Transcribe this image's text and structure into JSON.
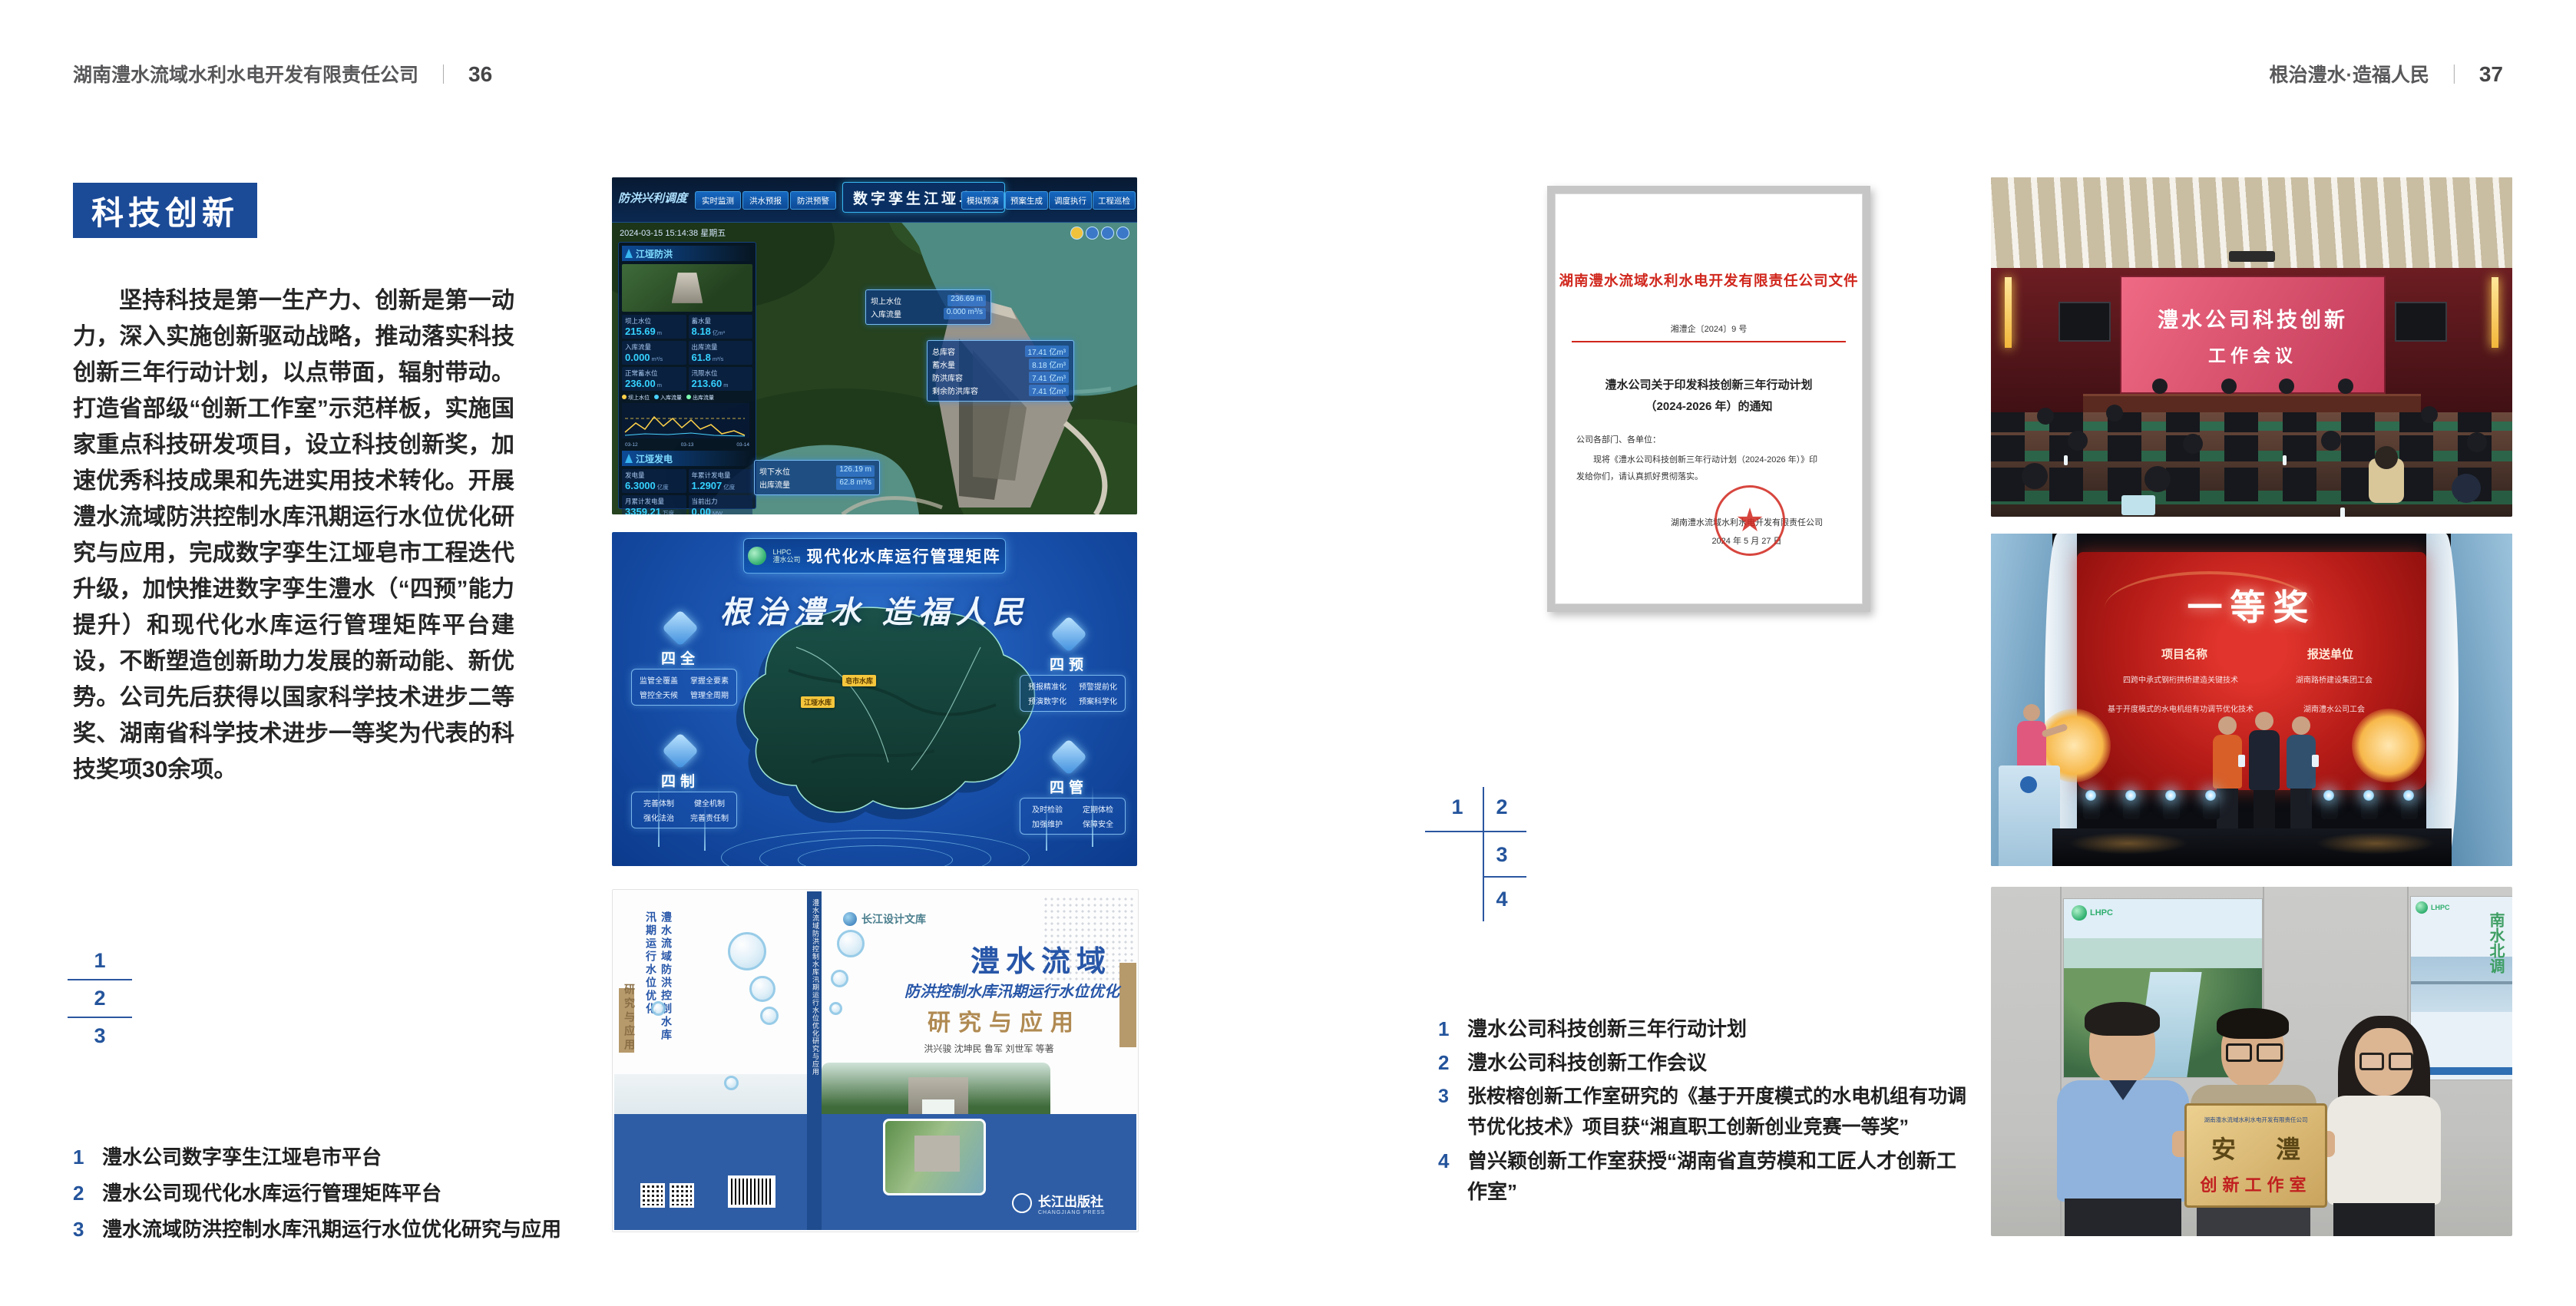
{
  "left": {
    "header": {
      "company": "湖南澧水流域水利水电开发有限责任公司",
      "sep": "｜",
      "page": "36"
    },
    "section_title": "科技创新",
    "body": "坚持科技是第一生产力、创新是第一动力，深入实施创新驱动战略，推动落实科技创新三年行动计划，以点带面，辐射带动。打造省部级“创新工作室”示范样板，实施国家重点科技研发项目，设立科技创新奖，加速优秀科技成果和先进实用技术转化。开展澧水流域防洪控制水库汛期运行水位优化研究与应用，完成数字孪生江垭皂市工程迭代升级，加快推进数字孪生澧水（“四预”能力提升）和现代化水库运行管理矩阵平台建设，不断塑造创新助力发展的新动能、新优势。公司先后获得以国家科学技术进步二等奖、湖南省科学技术进步一等奖为代表的科技奖项30余项。",
    "fig_index": [
      "1",
      "2",
      "3"
    ],
    "captions": [
      {
        "num": "1",
        "text": "澧水公司数字孪生江垭皂市平台"
      },
      {
        "num": "2",
        "text": "澧水公司现代化水库运行管理矩阵平台"
      },
      {
        "num": "3",
        "text": "澧水流域防洪控制水库汛期运行水位优化研究与应用"
      }
    ],
    "dashboard": {
      "corner_label": "防洪兴利调度",
      "title": "数字孪生江垭皂市",
      "tabs_left": [
        "实时监测",
        "洪水预报",
        "防洪预警"
      ],
      "tabs_right": [
        "模拟预演",
        "预案生成",
        "调度执行",
        "工程巡检"
      ],
      "timestamp": "2024-03-15 15:14:38 星期五",
      "panel1_title": "江垭防洪",
      "stats": [
        {
          "label": "坝上水位",
          "value": "215.69",
          "unit": "m"
        },
        {
          "label": "蓄水量",
          "value": "8.18",
          "unit": "亿m³"
        },
        {
          "label": "入库流量",
          "value": "0.000",
          "unit": "m³/s"
        },
        {
          "label": "出库流量",
          "value": "61.8",
          "unit": "m³/s"
        },
        {
          "label": "正常蓄水位",
          "value": "236.00",
          "unit": "m"
        },
        {
          "label": "汛限水位",
          "value": "213.60",
          "unit": "m"
        }
      ],
      "chart_legend": [
        "坝上水位",
        "入库流量",
        "出库流量"
      ],
      "chart_x": [
        "03-12",
        "03-13",
        "03-14"
      ],
      "panel2_title": "江垭发电",
      "power_stats": [
        {
          "label": "发电量",
          "value": "6.3000",
          "unit": "亿度"
        },
        {
          "label": "年累计发电量",
          "value": "1.2907",
          "unit": "亿度"
        },
        {
          "label": "月累计发电量",
          "value": "3359.21",
          "unit": "万度"
        },
        {
          "label": "当前出力",
          "value": "0.00",
          "unit": "MW"
        }
      ],
      "callout_up": {
        "l1_label": "坝上水位",
        "l1_value": "236.69 m",
        "l2_label": "入库流量",
        "l2_value": "0.000 m³/s"
      },
      "callout_info": [
        {
          "label": "总库容",
          "value": "17.41 亿m³"
        },
        {
          "label": "蓄水量",
          "value": "8.18 亿m³"
        },
        {
          "label": "防洪库容",
          "value": "7.41 亿m³"
        },
        {
          "label": "剩余防洪库容",
          "value": "7.41 亿m³"
        }
      ],
      "callout_down": {
        "l1_label": "坝下水位",
        "l1_value": "126.19 m",
        "l2_label": "出库流量",
        "l2_value": "62.8 m³/s"
      }
    },
    "matrix": {
      "logo_abbr": "LHPC",
      "logo_name": "澧水公司",
      "header_title": "现代化水库运行管理矩阵",
      "slogan": "根治澧水 造福人民",
      "labels": [
        "江垭水库",
        "皂市水库"
      ],
      "panels": [
        {
          "title": "四全",
          "items": [
            "监管全覆盖",
            "掌握全要素",
            "管控全天候",
            "管理全周期"
          ]
        },
        {
          "title": "四预",
          "items": [
            "预报精准化",
            "预警提前化",
            "预演数字化",
            "预案科学化"
          ]
        },
        {
          "title": "四制",
          "items": [
            "完善体制",
            "健全机制",
            "强化法治",
            "完善责任制"
          ]
        },
        {
          "title": "四管",
          "items": [
            "及时检验",
            "定期体检",
            "加强维护",
            "保障安全"
          ]
        }
      ]
    },
    "book": {
      "series": "长江设计文库",
      "title_main": "澧水流域",
      "title_sub": "防洪控制水库汛期运行水位优化",
      "title_tail": "研究与应用",
      "authors": "洪兴骏 沈坤民 鲁军 刘世军 等著",
      "spine": "澧水流域防洪控制水库汛期运行水位优化研究与应用",
      "back_title": "澧水流域防洪控制水库汛期运行水位优化",
      "back_tail": "研究与应用",
      "publisher": "长江出版社",
      "publisher_en": "CHANGJIANG PRESS"
    }
  },
  "right": {
    "header": {
      "slogan": "根治澧水·造福人民",
      "sep": "｜",
      "page": "37"
    },
    "document": {
      "title": "湖南澧水流域水利水电开发有限责任公司文件",
      "doc_no": "湘澧企〔2024〕9 号",
      "subject1": "澧水公司关于印发科技创新三年行动计划",
      "subject2": "（2024-2026 年）的通知",
      "salutation": "公司各部门、各单位：",
      "body1": "现将《澧水公司科技创新三年行动计划（2024-2026 年）》印",
      "body2": "发给你们，请认真抓好贯彻落实。",
      "signature": "湖南澧水流域水利水电开发有限责任公司",
      "date": "2024 年 5 月 27 日"
    },
    "fig_index": [
      "1",
      "2",
      "3",
      "4"
    ],
    "captions": [
      {
        "num": "1",
        "text": "澧水公司科技创新三年行动计划"
      },
      {
        "num": "2",
        "text": "澧水公司科技创新工作会议"
      },
      {
        "num": "3",
        "text": "张桉榕创新工作室研究的《基于开度模式的水电机组有功调节优化技术》项目获“湘直职工创新创业竞赛一等奖”"
      },
      {
        "num": "4",
        "text": "曾兴颖创新工作室获授“湖南省直劳模和工匠人才创新工作室”"
      }
    ],
    "meeting": {
      "screen_line1": "澧水公司科技创新",
      "screen_line2": "工作会议"
    },
    "award": {
      "screen_title": "一等奖",
      "col_left_header": "项目名称",
      "col_right_header": "报送单位",
      "col_left_items": [
        "四跨中承式钢桁拱桥建造关键技术",
        "基于开度模式的水电机组有功调节优化技术"
      ],
      "col_right_items": [
        "湖南路桥建设集团工会",
        "湖南澧水公司工会"
      ]
    },
    "plaque": {
      "org": "湖南澧水流域水利水电开发有限责任公司",
      "name": "安 澧",
      "subtitle": "创新工作室",
      "poster_vertical": "南水北调",
      "poster_logo": "LHPC"
    }
  }
}
